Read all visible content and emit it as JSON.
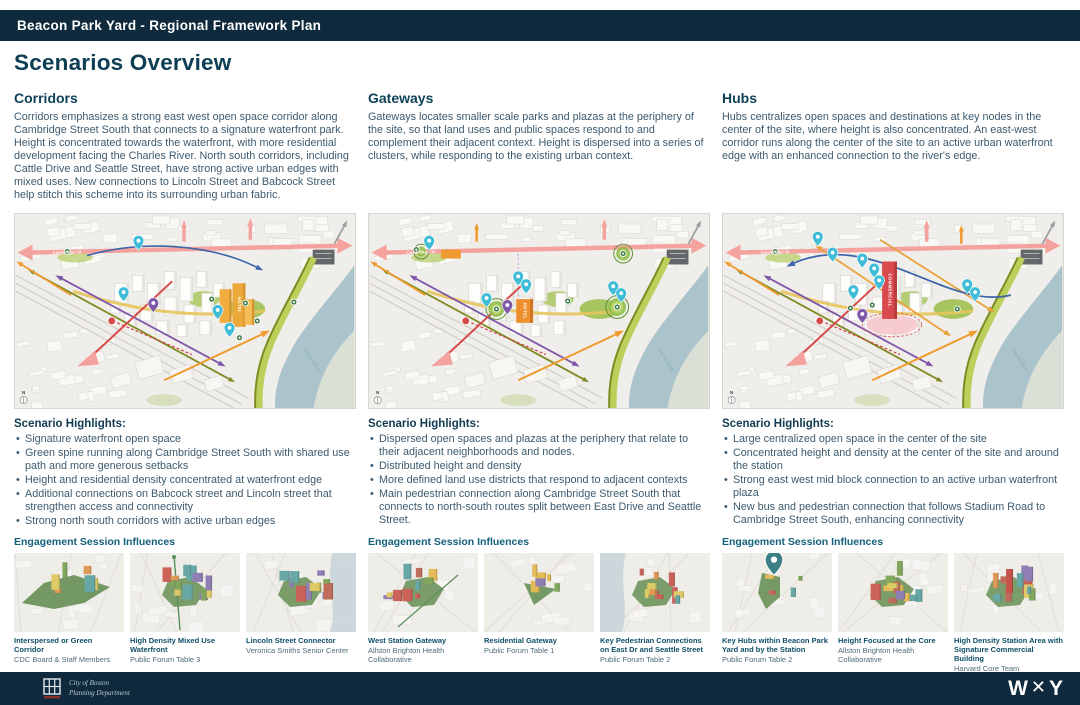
{
  "header": {
    "bar_title": "Beacon Park Yard - Regional Framework Plan"
  },
  "page": {
    "title": "Scenarios Overview"
  },
  "labels": {
    "scenario_highlights": "Scenario Highlights:",
    "engagement": "Engagement Session Influences"
  },
  "maps": {
    "street_label": "Cambridge St",
    "river_label": "Charles River",
    "compass": "N",
    "tower_labels": {
      "corridors": "HOTEL",
      "gateways": "HOTEL",
      "hubs": "COMMERCIAL"
    }
  },
  "columns": [
    {
      "title": "Corridors",
      "description": "Corridors emphasizes a strong east west open space corridor along Cambridge Street South that connects to a signature waterfront park. Height is concentrated towards the waterfront, with more residential development facing the Charles River. North south corridors, including Cattle Drive and Seattle Street, have strong active urban edges with mixed uses. New connections to Lincoln Street and Babcock Street help stitch this scheme into its surrounding urban fabric.",
      "highlights": [
        "Signature waterfront open space",
        "Green spine running along Cambridge Street South with shared use path and more generous setbacks",
        "Height and residential density concentrated at waterfront edge",
        "Additional connections on Babcock street and Lincoln street that strengthen access and connectivity",
        "Strong north south corridors with active urban edges"
      ],
      "engagement": [
        {
          "title": "Interspersed or Green Corridor",
          "source": "CDC Board & Staff Members"
        },
        {
          "title": "High Density Mixed Use Waterfront",
          "source": "Public Forum Table 3"
        },
        {
          "title": "Lincoln Street Connector",
          "source": "Veronica Smiths Senior Center"
        }
      ]
    },
    {
      "title": "Gateways",
      "description": "Gateways locates smaller scale parks and plazas at the periphery of the site, so that land uses and public spaces respond to and complement their adjacent context. Height is dispersed into a series of clusters, while responding to the existing urban context.",
      "highlights": [
        "Dispersed open spaces and plazas at the periphery that relate to their adjacent neighborhoods and nodes.",
        "Distributed height and density",
        "More defined land use districts that respond to adjacent contexts",
        "Main pedestrian connection along Cambridge Street South that connects to north-south routes split between East Drive and Seattle Street."
      ],
      "engagement": [
        {
          "title": "West Station Gateway",
          "source": "Allston Brighton Health Collaborative"
        },
        {
          "title": "Residential Gateway",
          "source": "Public Forum Table 1"
        },
        {
          "title": "Key Pedestrian Connections on East Dr and Seattle Street",
          "source": "Public Forum Table 2"
        }
      ]
    },
    {
      "title": "Hubs",
      "description": "Hubs centralizes open spaces and destinations at key nodes in the center of the site, where height is also concentrated. An east-west corridor runs along the center of the site to an active urban waterfront edge with an enhanced connection to the river's edge.",
      "highlights": [
        "Large centralized open space in the center of the site",
        "Concentrated height and density at the center of the site and around the station",
        "Strong east west mid block connection to an active urban waterfront plaza",
        "New bus and pedestrian connection that follows Stadium Road to Cambridge Street South, enhancing connectivity"
      ],
      "engagement": [
        {
          "title": "Key Hubs within Beacon Park Yard and by the Station",
          "source": "Public Forum Table 2"
        },
        {
          "title": "Height Focused at the Core",
          "source": "Allston Brighton Health Collaborative"
        },
        {
          "title": "High Density Station Area with Signature Commercial Building",
          "source": "Harvard Core Team"
        }
      ]
    }
  ],
  "footer": {
    "org_line1": "City of Boston",
    "org_line2": "Planning Department",
    "brand": {
      "w": "W",
      "x": "✕",
      "y": "Y"
    }
  },
  "colors": {
    "header_bar": "#0e2a3c",
    "heading": "#0c3e53",
    "body_text": "#3d5a6e",
    "teal_label": "#14607c"
  }
}
